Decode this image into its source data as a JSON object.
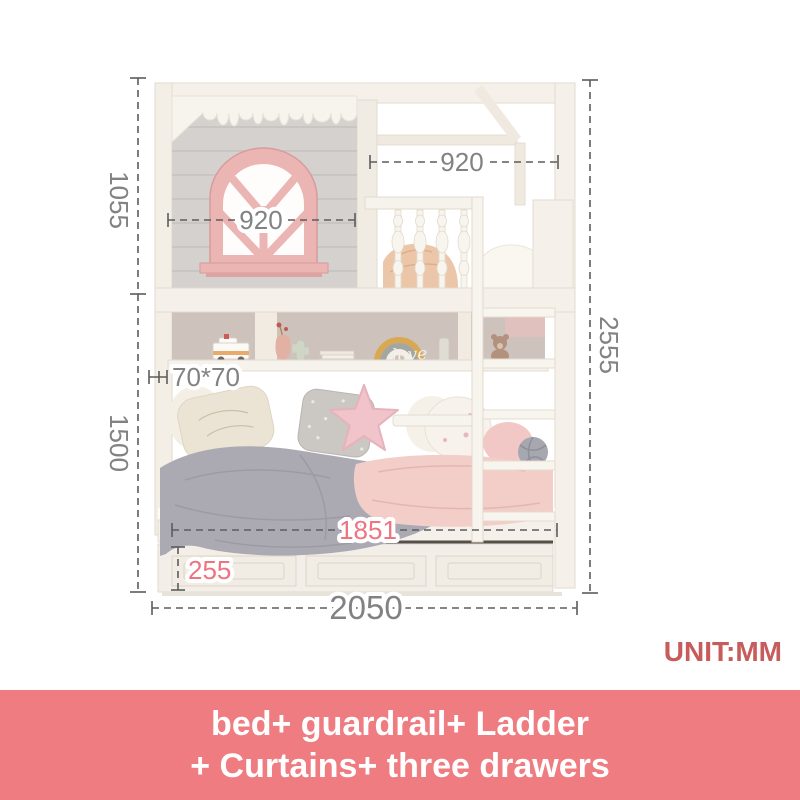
{
  "product_image": {
    "unit_label": "UNIT:MM",
    "dimensions": {
      "upper_section_height": "1055",
      "lower_section_height": "1500",
      "total_height": "2555",
      "window_width": "920",
      "top_frame_width": "920",
      "post_section": "70*70",
      "sleep_surface_length": "1851",
      "drawer_box_height": "255",
      "overall_length": "2050"
    },
    "shelf_sign_text": "love"
  },
  "banner": {
    "line1": "bed+ guardrail+ Ladder",
    "line2": "+ Curtains+ three drawers"
  },
  "colors": {
    "banner_bg": "#ee7c81",
    "unit_label_red": "#c65c5c",
    "dim_text_gray": "#828282",
    "dim_text_pink": "#ed7480",
    "window_pink": "#eab5b3",
    "wall_gray": "#d5d1ce",
    "wood_white": "#f5f1ea"
  }
}
